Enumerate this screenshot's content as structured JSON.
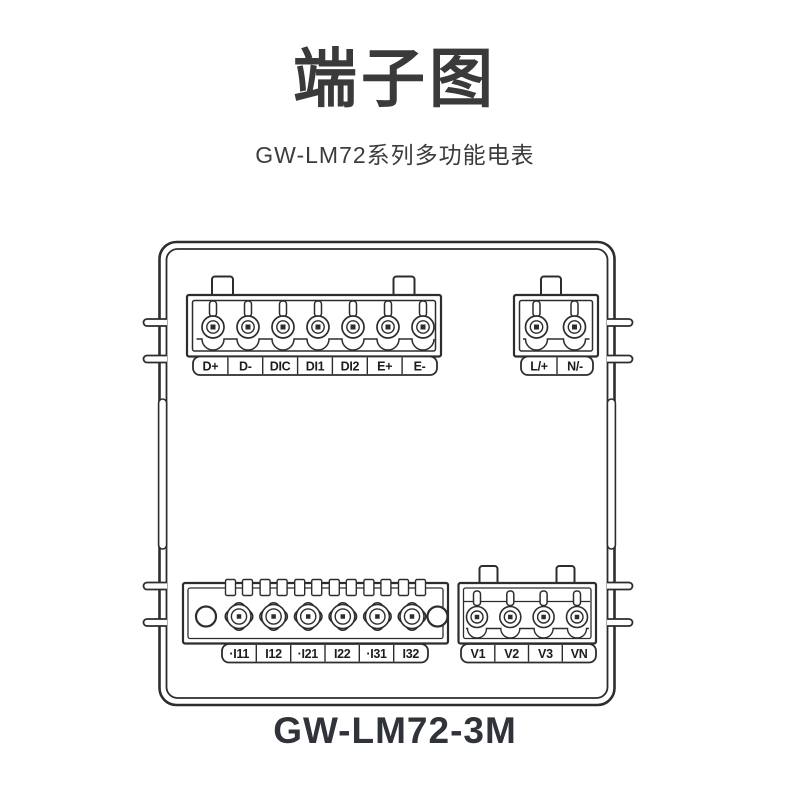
{
  "header": {
    "title": "端子图",
    "subtitle": "GW-LM72系列多功能电表"
  },
  "device": {
    "model_label": "GW-LM72-3M",
    "terminal_blocks": {
      "comm": {
        "labels": [
          "D+",
          "D-",
          "DIC",
          "DI1",
          "DI2",
          "E+",
          "E-"
        ]
      },
      "power": {
        "labels": [
          "L/+",
          "N/-"
        ]
      },
      "current": {
        "labels": [
          "·I11",
          "I12",
          "·I21",
          "I22",
          "·I31",
          "I32"
        ]
      },
      "voltage": {
        "labels": [
          "V1",
          "V2",
          "V3",
          "VN"
        ]
      }
    }
  },
  "colors": {
    "line": "#2d2d2d",
    "title_text": "#3a3a3a",
    "model_text": "#30333a",
    "background": "#ffffff"
  }
}
